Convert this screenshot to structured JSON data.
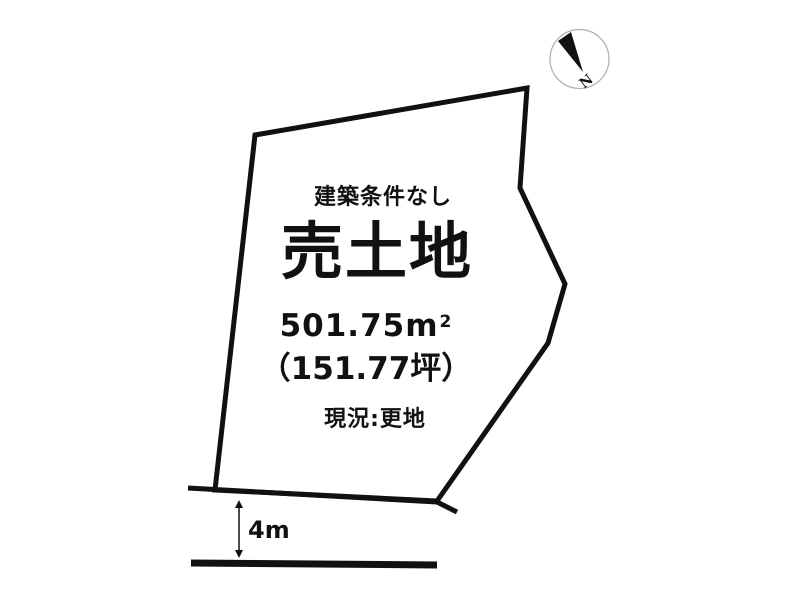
{
  "plot": {
    "condition_label": "建築条件なし",
    "sale_type_title": "売土地",
    "area_sqm_value": "501.75",
    "area_sqm_unit_base": "m",
    "area_sqm_unit_exponent": "2",
    "area_tsubo_label": "（151.77坪）",
    "current_status_label": "現況:更地"
  },
  "road": {
    "width_label": "4m"
  },
  "compass": {
    "north_label": "N"
  },
  "colors": {
    "ink": "#111111",
    "background": "#ffffff",
    "compass_ring": "#aeaeae"
  }
}
